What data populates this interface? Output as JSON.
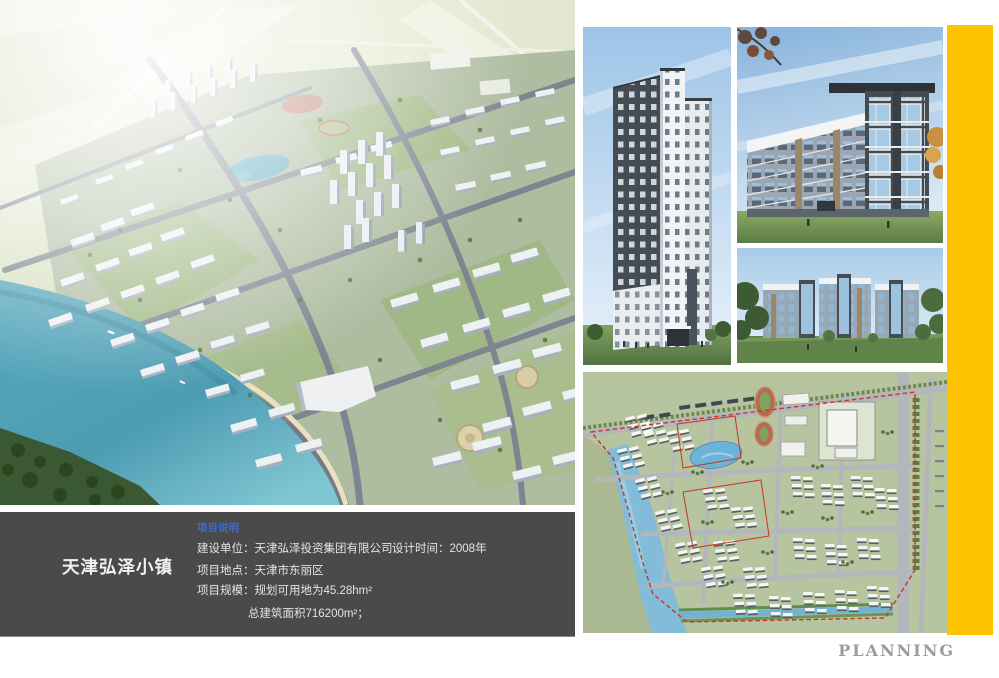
{
  "info_panel": {
    "title": "天津弘泽小镇",
    "section_label": "项目说明",
    "row1_left": "建设单位：天津弘泽投资集团有限公司",
    "row1_right": "设计时间：2008年",
    "row2": "项目地点：天津市东丽区",
    "row3": "项目规模：规划可用地为45.28hm²",
    "row4": "总建筑面积716200m²；"
  },
  "footer": {
    "label": "PLANNING"
  },
  "colors": {
    "page_background": "#ffffff",
    "accent_bar_yellow": "#fdc300",
    "info_panel_background": "#4a4a4b",
    "section_label_blue": "#3e6bd2",
    "planning_text_gray": "#9c9c9c"
  }
}
